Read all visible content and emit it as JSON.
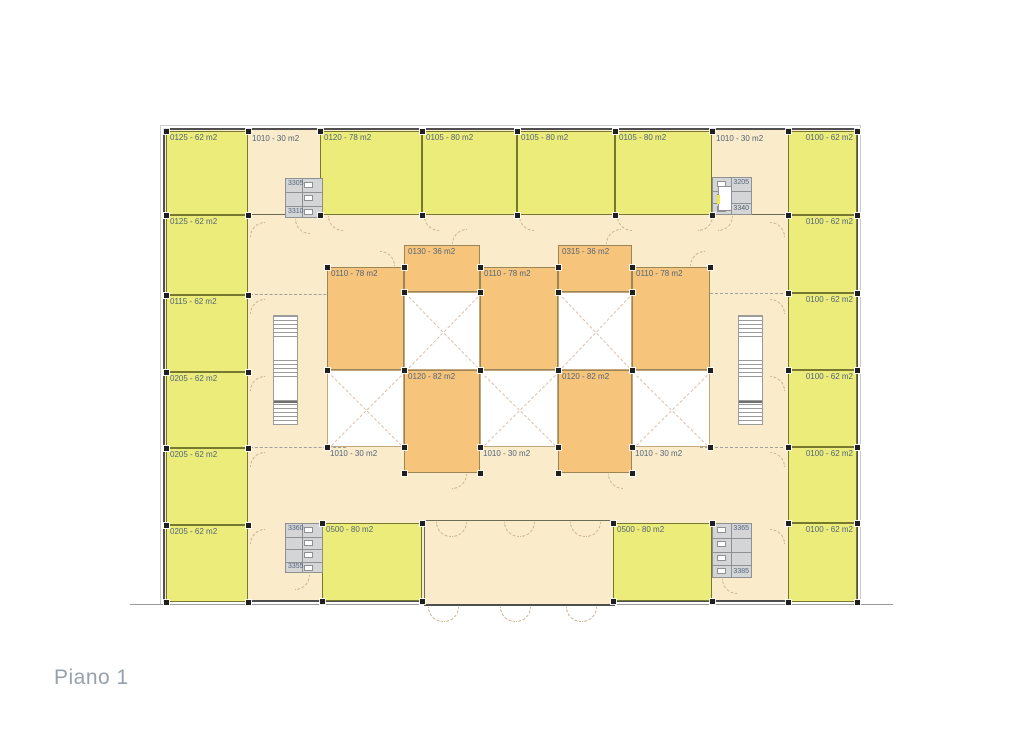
{
  "title": "Piano 1",
  "colors": {
    "floor": "#faecca",
    "green": "#ecec7b",
    "green_border": "#77782f",
    "orange": "#f7c47b",
    "orange_border": "#9a8556",
    "void_fill": "#ffffff",
    "void_border": "#c2a87c",
    "void_x": "#dcbfa8",
    "wall": "#4f4f4f",
    "wall_light": "#6b6b5a",
    "label": "#53657a",
    "service_fill": "#d4d5d6",
    "service_border": "#8f9092",
    "arc": "#cfb28e",
    "title": "#97a1ab",
    "marker": "#1f1f1f",
    "ground": "#9a9a9a",
    "fixture": "#ffffff",
    "elevator_accent": "#eeea43"
  },
  "plan": {
    "building": {
      "x": 163,
      "y": 128,
      "w": 695,
      "h": 474
    },
    "ground_line": {
      "x": 130,
      "y": 604,
      "w": 763
    },
    "lobby": {
      "x": 424,
      "y": 520,
      "w": 191,
      "h": 86
    },
    "rooms_green": [
      {
        "label": "0125 - 62 m2",
        "x": 166,
        "y": 131,
        "w": 82,
        "h": 84
      },
      {
        "label": "0125 - 62 m2",
        "x": 166,
        "y": 215,
        "w": 82,
        "h": 80
      },
      {
        "label": "0115 - 62 m2",
        "x": 166,
        "y": 295,
        "w": 82,
        "h": 77
      },
      {
        "label": "0205 - 62 m2",
        "x": 166,
        "y": 372,
        "w": 82,
        "h": 76
      },
      {
        "label": "0205 - 62 m2",
        "x": 166,
        "y": 448,
        "w": 82,
        "h": 77
      },
      {
        "label": "0205 - 62 m2",
        "x": 166,
        "y": 525,
        "w": 82,
        "h": 77
      },
      {
        "label": "0120 - 78 m2",
        "x": 320,
        "y": 131,
        "w": 102,
        "h": 84
      },
      {
        "label": "0105 - 80 m2",
        "x": 422,
        "y": 131,
        "w": 95,
        "h": 84
      },
      {
        "label": "0105 - 80 m2",
        "x": 517,
        "y": 131,
        "w": 98,
        "h": 84
      },
      {
        "label": "0105 - 80 m2",
        "x": 615,
        "y": 131,
        "w": 97,
        "h": 84
      },
      {
        "label": "0100 - 62 m2",
        "x": 788,
        "y": 131,
        "w": 69,
        "h": 84,
        "align": "right"
      },
      {
        "label": "0100 - 62 m2",
        "x": 788,
        "y": 215,
        "w": 69,
        "h": 78,
        "align": "right"
      },
      {
        "label": "0100 - 62 m2",
        "x": 788,
        "y": 293,
        "w": 69,
        "h": 77,
        "align": "right"
      },
      {
        "label": "0100 - 62 m2",
        "x": 788,
        "y": 370,
        "w": 69,
        "h": 77,
        "align": "right"
      },
      {
        "label": "0100 - 62 m2",
        "x": 788,
        "y": 447,
        "w": 69,
        "h": 76,
        "align": "right"
      },
      {
        "label": "0100 - 62 m2",
        "x": 788,
        "y": 523,
        "w": 69,
        "h": 79,
        "align": "right"
      },
      {
        "label": "0500 - 80 m2",
        "x": 322,
        "y": 523,
        "w": 100,
        "h": 78
      },
      {
        "label": "0500 - 80 m2",
        "x": 613,
        "y": 523,
        "w": 99,
        "h": 78
      }
    ],
    "rooms_orange": [
      {
        "label": "0130 - 36 m2",
        "x": 404,
        "y": 245,
        "w": 76,
        "h": 47,
        "nomarker": true
      },
      {
        "label": "0315 - 36 m2",
        "x": 558,
        "y": 245,
        "w": 74,
        "h": 47,
        "nomarker": true
      },
      {
        "label": "0110 - 78 m2",
        "x": 327,
        "y": 267,
        "w": 77,
        "h": 103
      },
      {
        "label": "0110 - 78 m2",
        "x": 480,
        "y": 267,
        "w": 78,
        "h": 103
      },
      {
        "label": "0110 - 78 m2",
        "x": 632,
        "y": 267,
        "w": 78,
        "h": 103
      },
      {
        "label": "0120 - 82 m2",
        "x": 404,
        "y": 370,
        "w": 76,
        "h": 103
      },
      {
        "label": "0120 - 82 m2",
        "x": 558,
        "y": 370,
        "w": 74,
        "h": 103
      }
    ],
    "voids": [
      {
        "x": 404,
        "y": 292,
        "w": 76,
        "h": 78
      },
      {
        "x": 558,
        "y": 292,
        "w": 74,
        "h": 78
      },
      {
        "x": 327,
        "y": 370,
        "w": 77,
        "h": 77,
        "label": "1010 - 30 m2"
      },
      {
        "x": 480,
        "y": 370,
        "w": 78,
        "h": 77,
        "label": "1010 - 30 m2"
      },
      {
        "x": 632,
        "y": 370,
        "w": 78,
        "h": 77,
        "label": "1010 - 30 m2"
      }
    ],
    "corridor_labels": [
      {
        "label": "1010 - 30 m2",
        "x": 252,
        "y": 134
      },
      {
        "label": "1010 - 30 m2",
        "x": 716,
        "y": 134
      }
    ],
    "service_blocks": [
      {
        "x": 285,
        "y": 178,
        "w": 38,
        "h": 40,
        "label_top": "3305",
        "label_bottom": "3310",
        "fixtures_side": "right"
      },
      {
        "x": 712,
        "y": 177,
        "w": 40,
        "h": 38,
        "label_top": "3205",
        "label_bottom": "3340",
        "fixtures_side": "left",
        "elevator": true
      },
      {
        "x": 285,
        "y": 523,
        "w": 38,
        "h": 50,
        "label_top": "3360",
        "label_bottom": "3355",
        "fixtures_side": "right"
      },
      {
        "x": 712,
        "y": 523,
        "w": 40,
        "h": 55,
        "label_top": "3365",
        "label_bottom": "3385",
        "fixtures_side": "left"
      }
    ],
    "stairs": [
      {
        "x": 273,
        "y": 315,
        "w": 25,
        "h": 110
      },
      {
        "x": 738,
        "y": 315,
        "w": 25,
        "h": 110
      }
    ],
    "walls": [
      {
        "x": 248,
        "y": 214,
        "w": 72,
        "h": 1
      },
      {
        "x": 712,
        "y": 214,
        "w": 76,
        "h": 1
      }
    ],
    "dash_lines": [
      {
        "x": 250,
        "y": 294,
        "w": 96
      },
      {
        "x": 250,
        "y": 447,
        "w": 96
      },
      {
        "x": 700,
        "y": 293,
        "w": 88
      },
      {
        "x": 700,
        "y": 447,
        "w": 88
      }
    ],
    "door_arcs": [
      {
        "x": 250,
        "y": 222,
        "r": 0
      },
      {
        "x": 250,
        "y": 299,
        "r": 0
      },
      {
        "x": 250,
        "y": 376,
        "r": 0
      },
      {
        "x": 250,
        "y": 452,
        "r": 0
      },
      {
        "x": 250,
        "y": 529,
        "r": 0
      },
      {
        "x": 770,
        "y": 222,
        "r": 90
      },
      {
        "x": 770,
        "y": 299,
        "r": 90
      },
      {
        "x": 770,
        "y": 376,
        "r": 90
      },
      {
        "x": 770,
        "y": 452,
        "r": 90
      },
      {
        "x": 770,
        "y": 529,
        "r": 90
      },
      {
        "x": 328,
        "y": 216,
        "r": 270
      },
      {
        "x": 424,
        "y": 216,
        "r": 270
      },
      {
        "x": 519,
        "y": 216,
        "r": 270
      },
      {
        "x": 617,
        "y": 216,
        "r": 270
      },
      {
        "x": 698,
        "y": 216,
        "r": 180
      },
      {
        "x": 295,
        "y": 219,
        "r": 270
      },
      {
        "x": 718,
        "y": 216,
        "r": 180
      },
      {
        "x": 295,
        "y": 575,
        "r": 180
      },
      {
        "x": 722,
        "y": 579,
        "r": 270
      },
      {
        "x": 452,
        "y": 229,
        "r": 0
      },
      {
        "x": 606,
        "y": 229,
        "r": 0
      },
      {
        "x": 380,
        "y": 251,
        "r": 90
      },
      {
        "x": 690,
        "y": 251,
        "r": 0
      },
      {
        "x": 452,
        "y": 474,
        "r": 180
      },
      {
        "x": 608,
        "y": 474,
        "r": 270
      },
      {
        "x": 436,
        "y": 522,
        "r": 270
      },
      {
        "x": 452,
        "y": 522,
        "r": 180
      },
      {
        "x": 504,
        "y": 522,
        "r": 270
      },
      {
        "x": 520,
        "y": 522,
        "r": 180
      },
      {
        "x": 570,
        "y": 522,
        "r": 270
      },
      {
        "x": 586,
        "y": 522,
        "r": 180
      },
      {
        "x": 428,
        "y": 607,
        "r": 270
      },
      {
        "x": 444,
        "y": 607,
        "r": 180
      },
      {
        "x": 500,
        "y": 607,
        "r": 270
      },
      {
        "x": 516,
        "y": 607,
        "r": 180
      },
      {
        "x": 566,
        "y": 607,
        "r": 270
      },
      {
        "x": 582,
        "y": 607,
        "r": 180
      }
    ]
  }
}
